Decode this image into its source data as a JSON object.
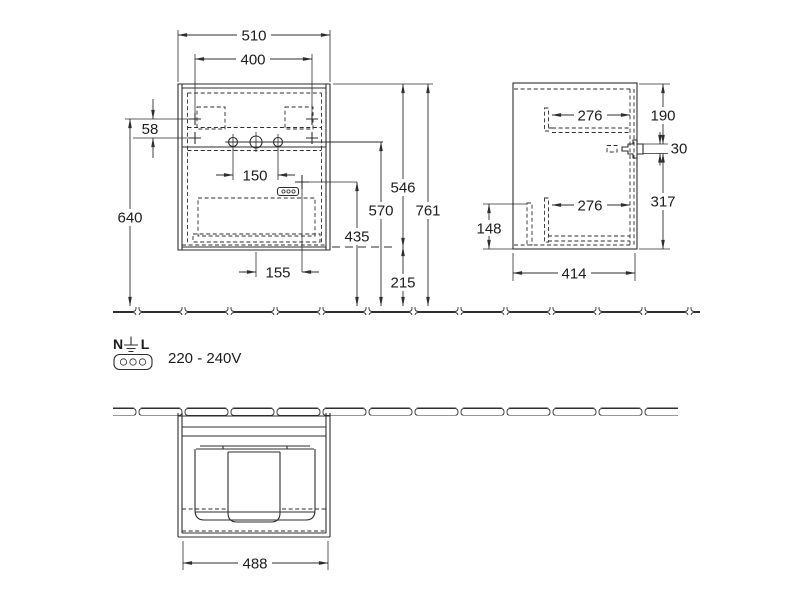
{
  "front_view": {
    "dims": {
      "cabinet_width": "510",
      "mounting_span": "400",
      "mounting_offset": "58",
      "mounting_height": "640",
      "faucet_hole_spacing": "150",
      "socket_offset_x": "155",
      "socket_height": "435",
      "faucet_line_height": "570",
      "cabinet_height": "546",
      "total_height": "761",
      "floor_clearance": "215"
    }
  },
  "side_view": {
    "dims": {
      "top_rail_length": "276",
      "top_offset": "190",
      "bracket_thickness": "30",
      "bottom_rail_length": "276",
      "lower_height": "317",
      "clip_height": "148",
      "cabinet_depth": "414"
    }
  },
  "plan_view": {
    "dims": {
      "inner_width": "488"
    }
  },
  "electrical": {
    "terminal_left": "N",
    "terminal_right": "L",
    "voltage_range": "220 - 240V"
  },
  "colors": {
    "line": "#2e2e2e",
    "background": "#ffffff"
  }
}
